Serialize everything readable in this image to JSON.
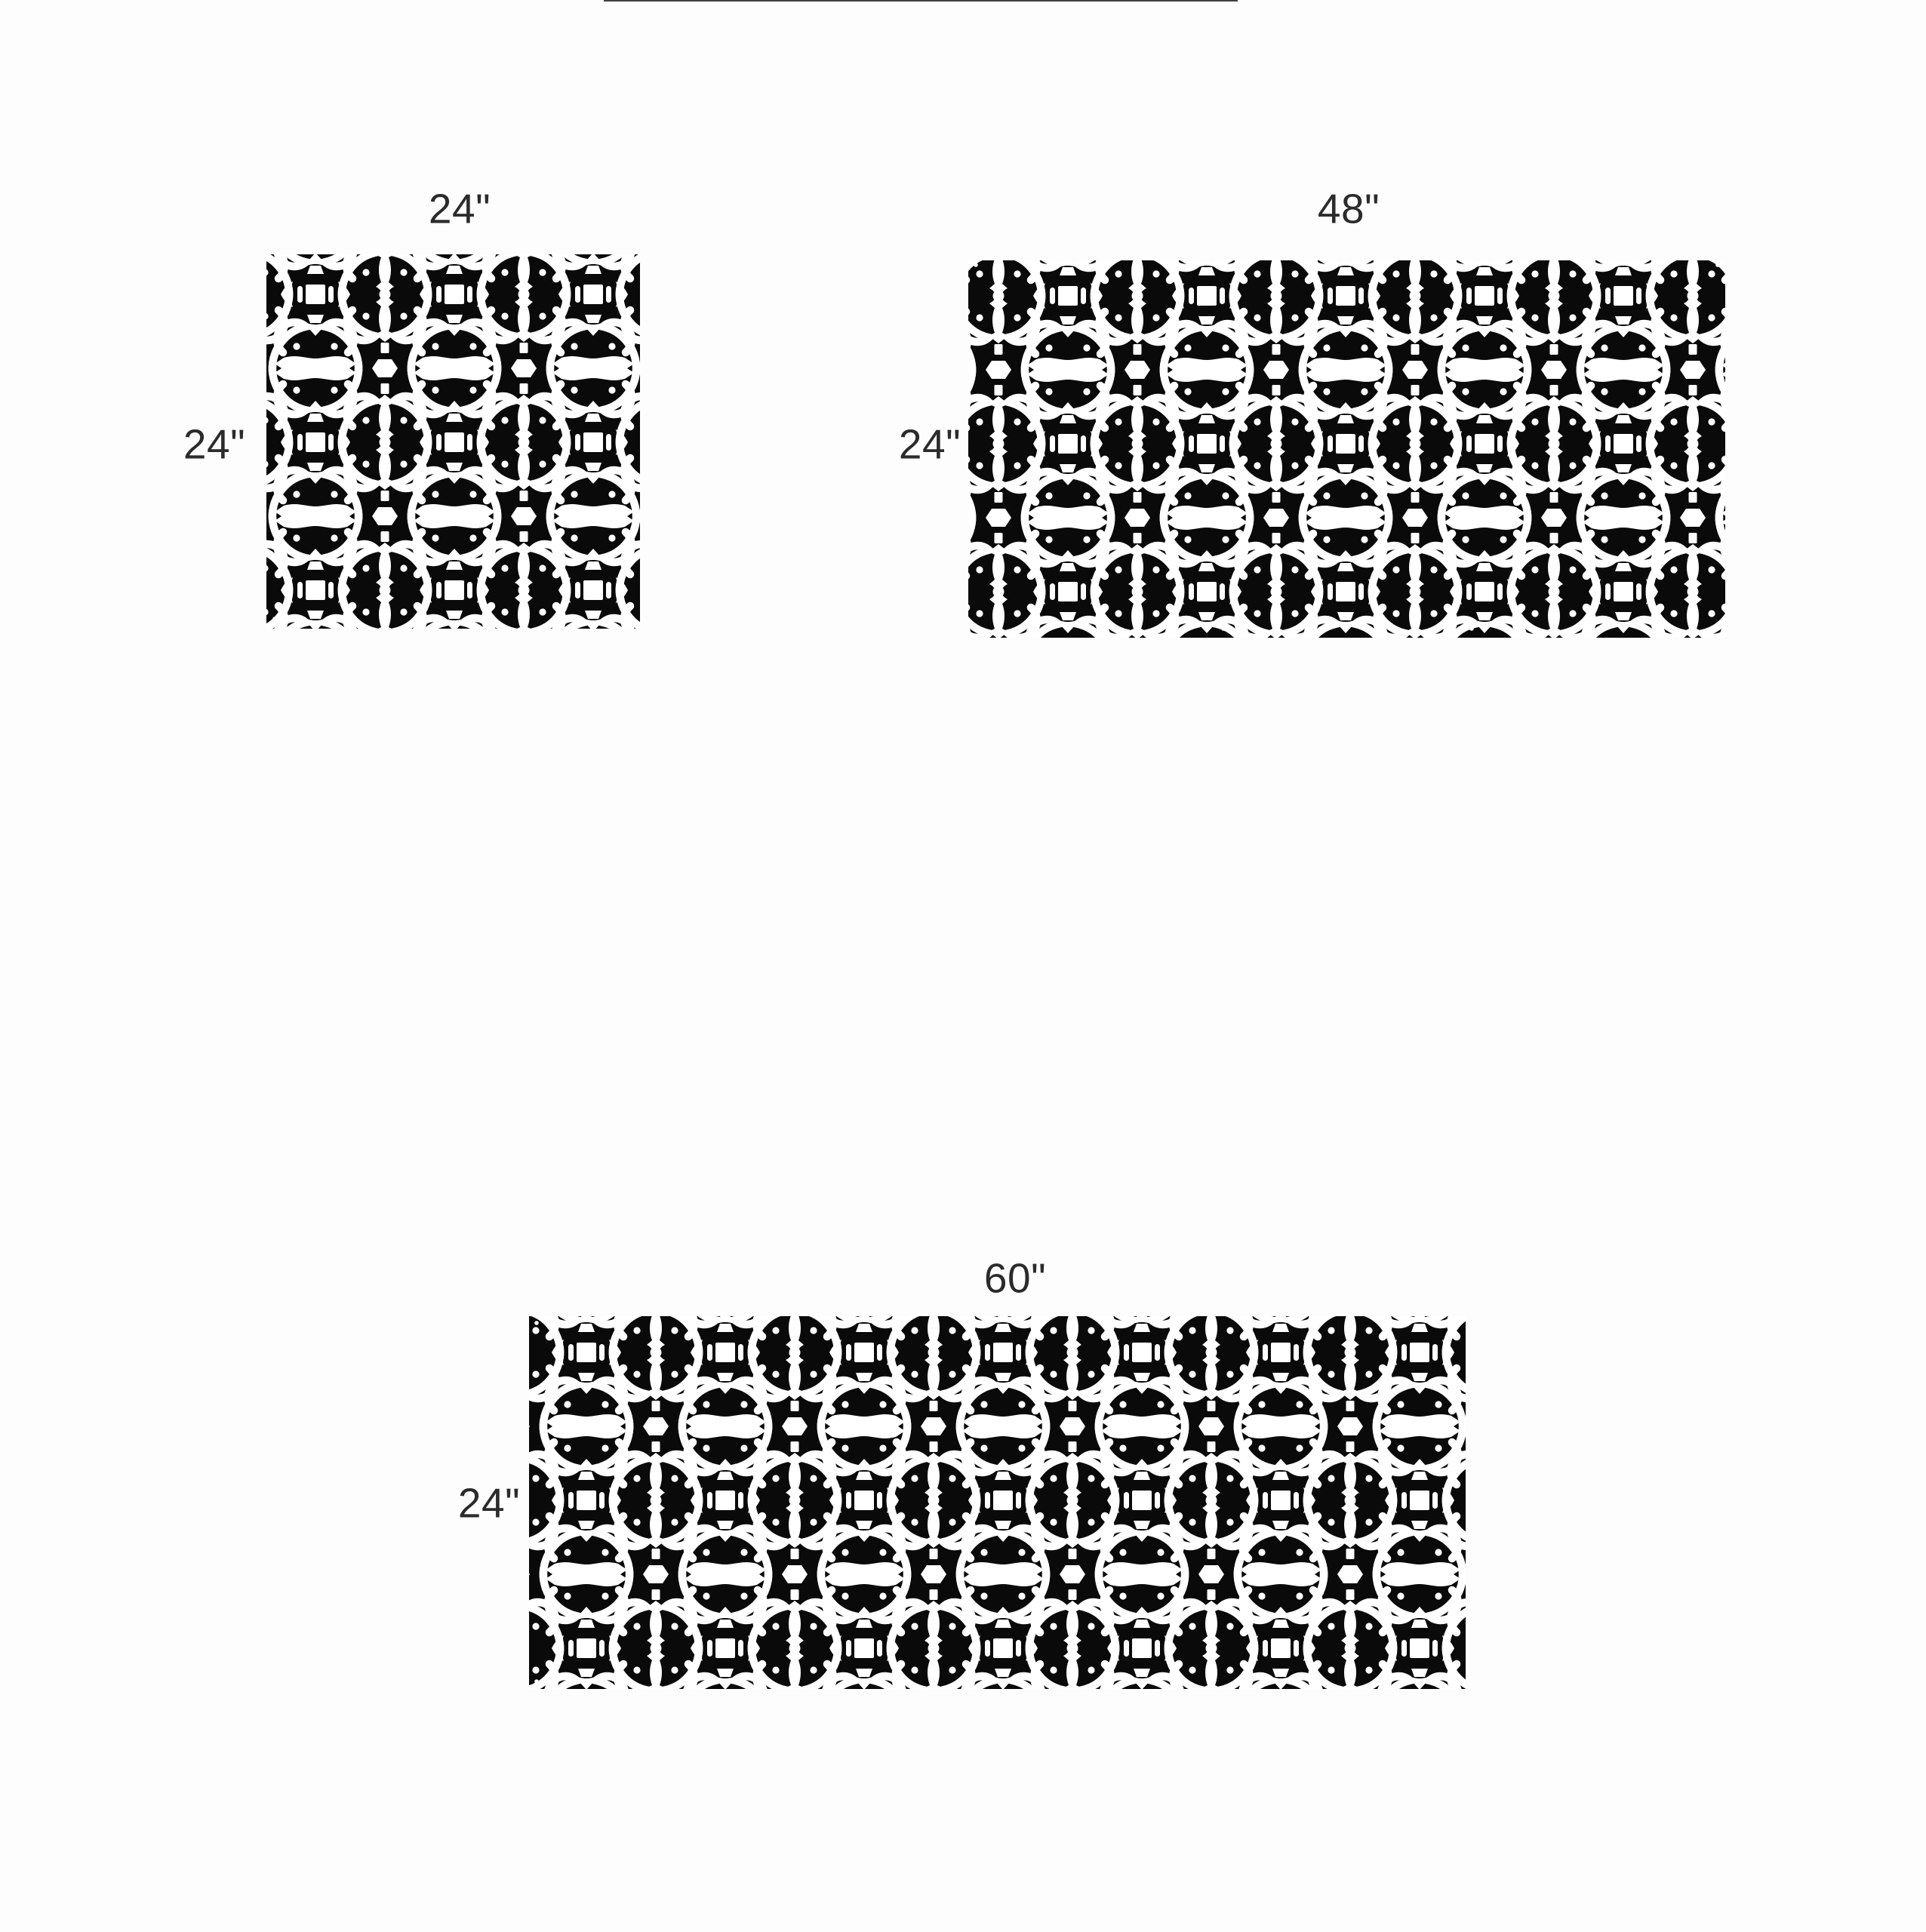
{
  "diagram": {
    "title": "decorative-screen-panel-size-diagram",
    "background_color": "#fdfdfd",
    "panel_color": "#0a0a0a",
    "cutout_color": "#ffffff",
    "hole_color": "#ffffff",
    "label_color": "#2b2b2b",
    "pattern_style": "ornamental-scroll-lattice",
    "panels": [
      {
        "name": "panel-24x24",
        "width_label": "24\"",
        "height_label": "24\""
      },
      {
        "name": "panel-48x24",
        "width_label": "48\"",
        "height_label": "24\""
      },
      {
        "name": "panel-60x24",
        "width_label": "60\"",
        "height_label": "24\""
      }
    ]
  }
}
